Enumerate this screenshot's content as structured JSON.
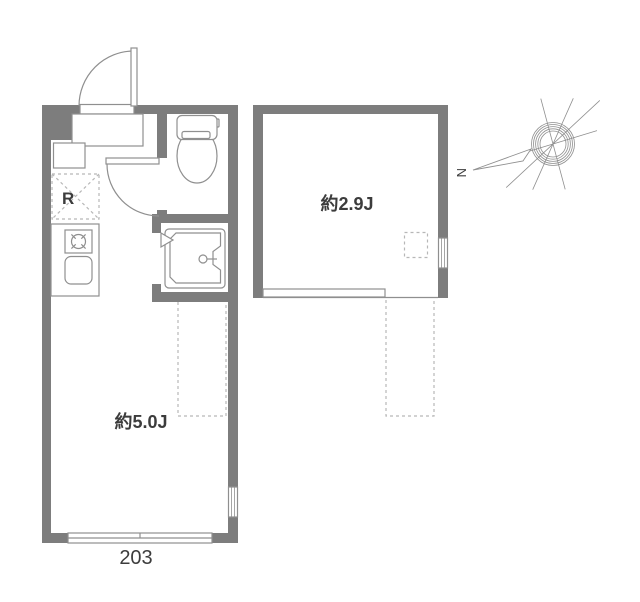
{
  "colors": {
    "wall": "#7d7d7d",
    "line": "#8f8f8f",
    "dash": "#b7b7b7",
    "text": "#3c3c3c"
  },
  "floorplan": {
    "unit_number": "203",
    "rooms": [
      {
        "name": "main-room",
        "label": "約5.0J"
      },
      {
        "name": "loft-room",
        "label": "約2.9J"
      }
    ],
    "labels": {
      "refrigerator": "R",
      "north": "N"
    }
  }
}
